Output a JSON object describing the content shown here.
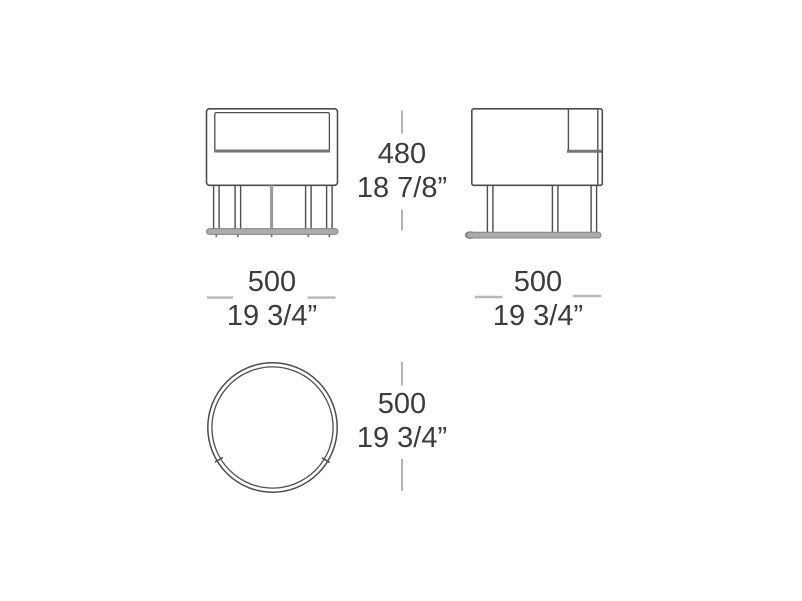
{
  "dimensions": {
    "height": {
      "mm": "480",
      "inches": "18 7/8”"
    },
    "front_width": {
      "mm": "500",
      "inches": "19 3/4”"
    },
    "side_width": {
      "mm": "500",
      "inches": "19 3/4”"
    },
    "top_diameter": {
      "mm": "500",
      "inches": "19 3/4”"
    }
  },
  "colors": {
    "line": "#4d4d4d",
    "line_thick": "#757575",
    "pole": "#9a9a9a",
    "base_fill": "#ababab",
    "base_stroke": "#848484",
    "tick_light": "#b8b8b8",
    "tick_gray": "#9a9a9a",
    "text": "#3c3c3c",
    "foot": "#6f6f6f",
    "bg": "#ffffff"
  }
}
